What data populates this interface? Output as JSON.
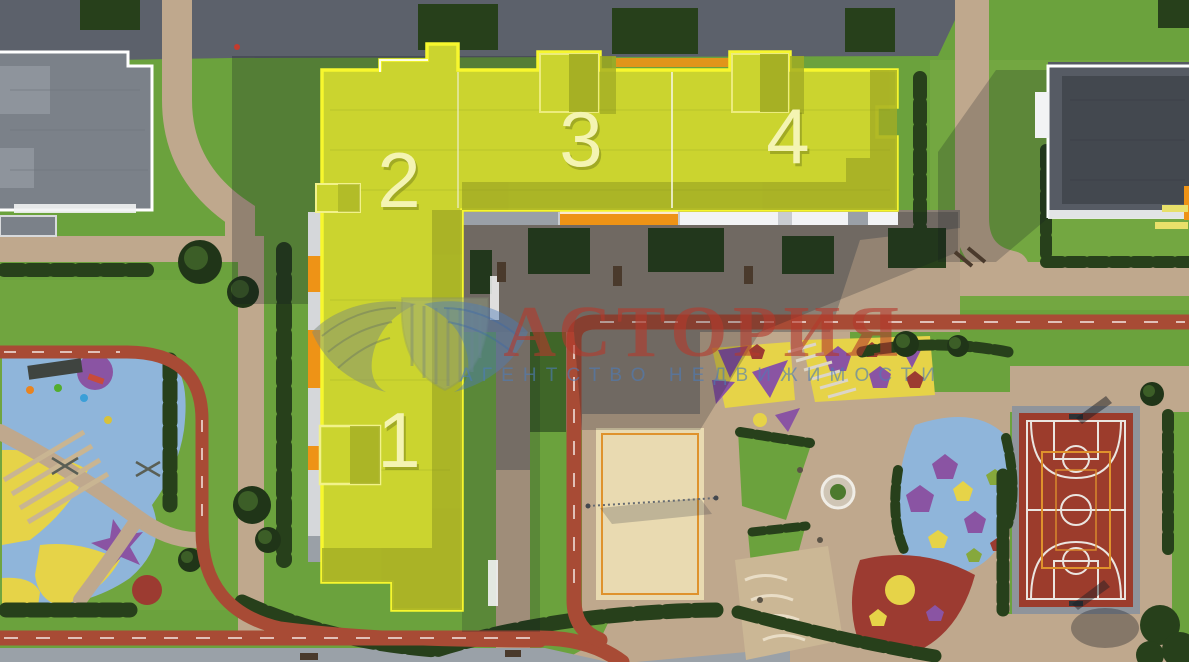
{
  "view": {
    "name": "residential-complex-masterplan-aerial",
    "description": "Aerial 3D masterplan render with a highlighted L-shaped residential building and numbered sections"
  },
  "watermark": {
    "title": "АСТОРИЯ",
    "subtitle": "АГЕНТСТВО НЕДВИЖИМОСТИ",
    "logo": "winged-shield-logo"
  },
  "building": {
    "name": "highlighted-residential-building",
    "sections": [
      {
        "id": "section-1",
        "label": "1"
      },
      {
        "id": "section-2",
        "label": "2"
      },
      {
        "id": "section-3",
        "label": "3"
      },
      {
        "id": "section-4",
        "label": "4"
      }
    ]
  },
  "features": [
    {
      "name": "kids-playground-left"
    },
    {
      "name": "kids-playground-right"
    },
    {
      "name": "sand-volleyball-court"
    },
    {
      "name": "basketball-court"
    },
    {
      "name": "running-track"
    },
    {
      "name": "neighbor-building-top-left"
    },
    {
      "name": "neighbor-building-top-right"
    }
  ],
  "colors": {
    "lawn": "#6ba23d",
    "lawn-light": "#7bac46",
    "lawn-shade": "#3f6628",
    "asphalt": "#5c616b",
    "path": "#bfa88d",
    "path-shade": "#8b8175",
    "sidewalk": "#9aa1a8",
    "hedge": "#27401b",
    "tree-dark": "#203518",
    "tree-light": "#3c5e27",
    "track": "#a84b35",
    "roof-left": "#7b8189",
    "roof-left-light": "#8e949c",
    "roof-right": "#565b64",
    "roof-right-dark": "#43484f",
    "white": "#f2f3f4",
    "facade-orange": "#ee9316",
    "highlight": "#cbd42f",
    "highlight-shade": "#a2ac24",
    "highlight-border": "#f7f72e",
    "section-label": "#f4f4b2",
    "sand": "#e9dab1",
    "court-red": "#9c3c2c",
    "court-frame": "#8f949b",
    "court-line": "#eae5e0",
    "court-orange": "#df922c",
    "blue-rubber": "#8fb5da",
    "purple": "#8a54a3",
    "play-yellow": "#e6d348",
    "red-rubber": "#9c3b31",
    "wm-red": "#b5392c",
    "wm-blue": "#4d7cb8",
    "wm-olive": "#7e8b77"
  }
}
